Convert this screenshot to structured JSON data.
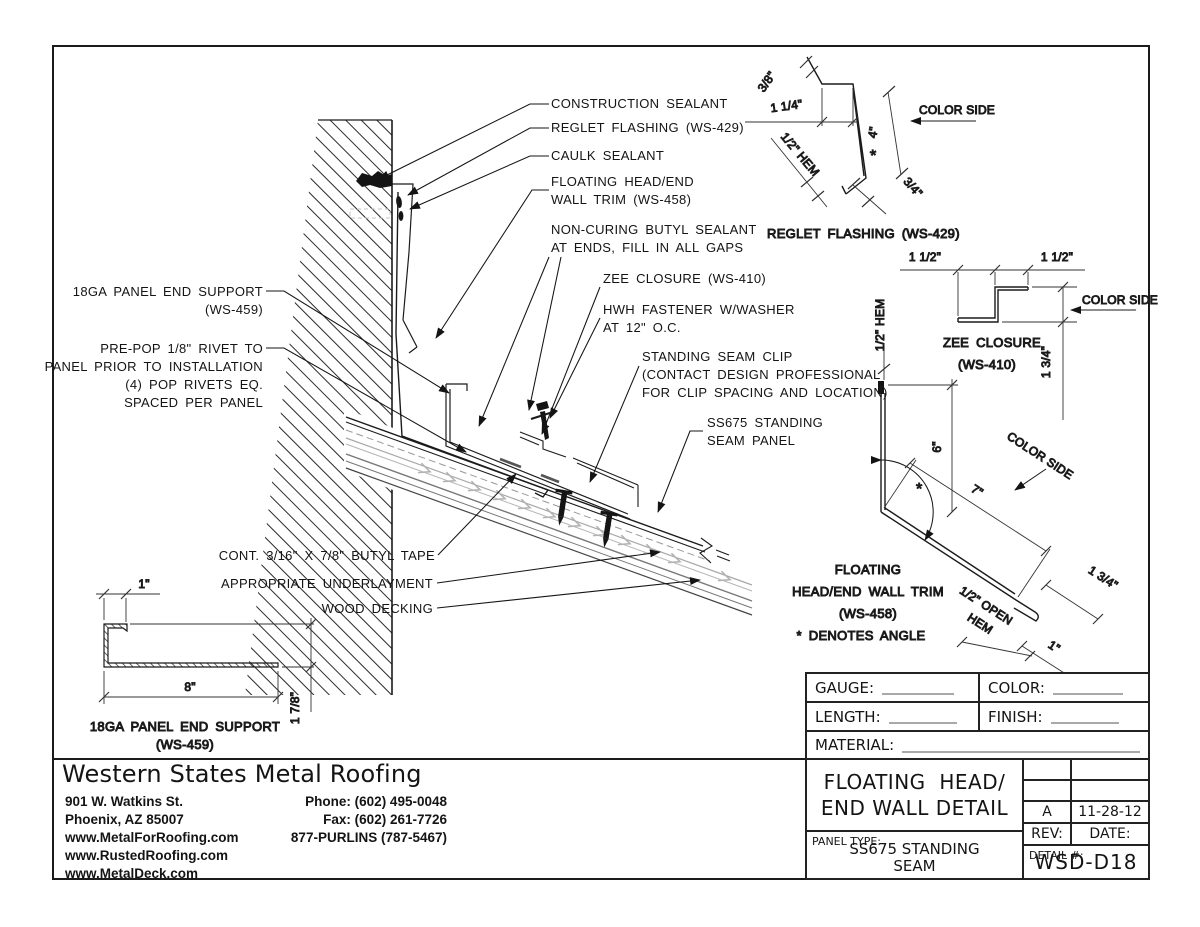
{
  "callouts": {
    "construction_sealant": "CONSTRUCTION SEALANT",
    "reglet_flashing": "REGLET FLASHING (WS-429)",
    "caulk_sealant": "CAULK SEALANT",
    "floating_trim_l1": "FLOATING HEAD/END",
    "floating_trim_l2": "WALL TRIM (WS-458)",
    "butyl_sealant_l1": "NON-CURING BUTYL SEALANT",
    "butyl_sealant_l2": "AT ENDS, FILL IN ALL GAPS",
    "zee_closure": "ZEE CLOSURE (WS-410)",
    "hwh_fastener_l1": "HWH FASTENER W/WASHER",
    "hwh_fastener_l2": "AT 12\" O.C.",
    "seam_clip_l1": "STANDING SEAM CLIP",
    "seam_clip_l2": "(CONTACT DESIGN PROFESSIONAL",
    "seam_clip_l3": "FOR CLIP SPACING AND LOCATION)",
    "seam_panel_l1": "SS675 STANDING",
    "seam_panel_l2": "SEAM PANEL",
    "end_support_l1": "18GA PANEL END SUPPORT",
    "end_support_l2": "(WS-459)",
    "rivet_l1": "PRE-POP 1/8\" RIVET TO",
    "rivet_l2": "PANEL PRIOR TO INSTALLATION",
    "rivet_l3": "(4) POP RIVETS EQ.",
    "rivet_l4": "SPACED PER PANEL",
    "butyl_tape": "CONT. 3/16\" X 7/8\" BUTYL TAPE",
    "underlayment": "APPROPRIATE UNDERLAYMENT",
    "wood_decking": "WOOD DECKING"
  },
  "reglet_detail": {
    "dim_3_8": "3/8\"",
    "dim_1_1_4": "1 1/4\"",
    "dim_half_hem": "1/2\" HEM",
    "dim_4": "4\"",
    "asterisk": "*",
    "dim_3_4": "3/4\"",
    "color_side": "COLOR SIDE",
    "title": "REGLET FLASHING (WS-429)"
  },
  "zee_detail": {
    "dim_left": "1 1/2\"",
    "dim_right": "1 1/2\"",
    "dim_web": "1 3/4\"",
    "color_side": "COLOR SIDE",
    "title_l1": "ZEE CLOSURE",
    "title_l2": "(WS-410)"
  },
  "trim_detail": {
    "dim_half_hem": "1/2\" HEM",
    "dim_6": "6\"",
    "dim_7": "7\"",
    "asterisk": "*",
    "color_side": "COLOR SIDE",
    "dim_1_3_4": "1 3/4\"",
    "dim_1": "1\"",
    "open_hem_l1": "1/2\" OPEN",
    "open_hem_l2": "HEM",
    "label_l1": "FLOATING",
    "label_l2": "HEAD/END WALL TRIM",
    "label_l3": "(WS-458)",
    "label_l4": "* DENOTES ANGLE"
  },
  "support_detail": {
    "dim_1": "1\"",
    "dim_8": "8\"",
    "dim_1_7_8": "1 7/8\"",
    "title_l1": "18GA PANEL END SUPPORT",
    "title_l2": "(WS-459)"
  },
  "title_block": {
    "gauge_label": "GAUGE:",
    "color_label": "COLOR:",
    "length_label": "LENGTH:",
    "finish_label": "FINISH:",
    "material_label": "MATERIAL:",
    "title_l1": "FLOATING  HEAD/",
    "title_l2": "END WALL DETAIL",
    "rev_value": "A",
    "date_value": "11-28-12",
    "rev_label": "REV:",
    "date_label": "DATE:",
    "panel_type_label": "PANEL TYPE:",
    "panel_type_l1": "SS675 STANDING",
    "panel_type_l2": "SEAM",
    "detail_label": "DETAIL #:",
    "detail_number": "WSD-D18"
  },
  "company": {
    "name": "Western States Metal Roofing",
    "address_l1": "901 W. Watkins St.",
    "address_l2": "Phoenix, AZ 85007",
    "website_1": "www.MetalForRoofing.com",
    "website_2": "www.RustedRoofing.com",
    "website_3": "www.MetalDeck.com",
    "phone": "Phone: (602) 495-0048",
    "fax": "Fax: (602) 261-7726",
    "toll_free": "877-PURLINS (787-5467)"
  }
}
